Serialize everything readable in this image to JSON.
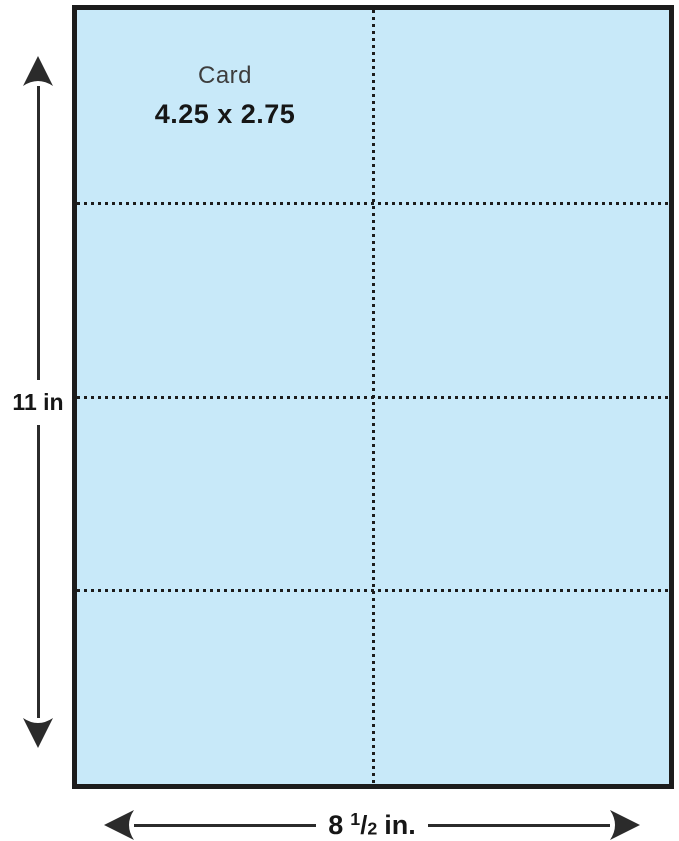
{
  "figure": {
    "description": "Perforated card stock sheet template diagram, 2 columns by 4 rows of cards",
    "card": {
      "title": "Card",
      "size": "4.25 x 2.75"
    },
    "dimensions": {
      "height_label": "11 in",
      "width_whole": "8",
      "width_frac_numerator": "1",
      "width_frac_slash": "/",
      "width_frac_denominator": "2",
      "width_unit": "in."
    },
    "grid": {
      "columns": 2,
      "rows": 4
    },
    "colors": {
      "paper_fill": "#c8e9f9",
      "line": "#1c1c1c",
      "arrow": "#2b2b2b",
      "background": "#ffffff"
    }
  }
}
